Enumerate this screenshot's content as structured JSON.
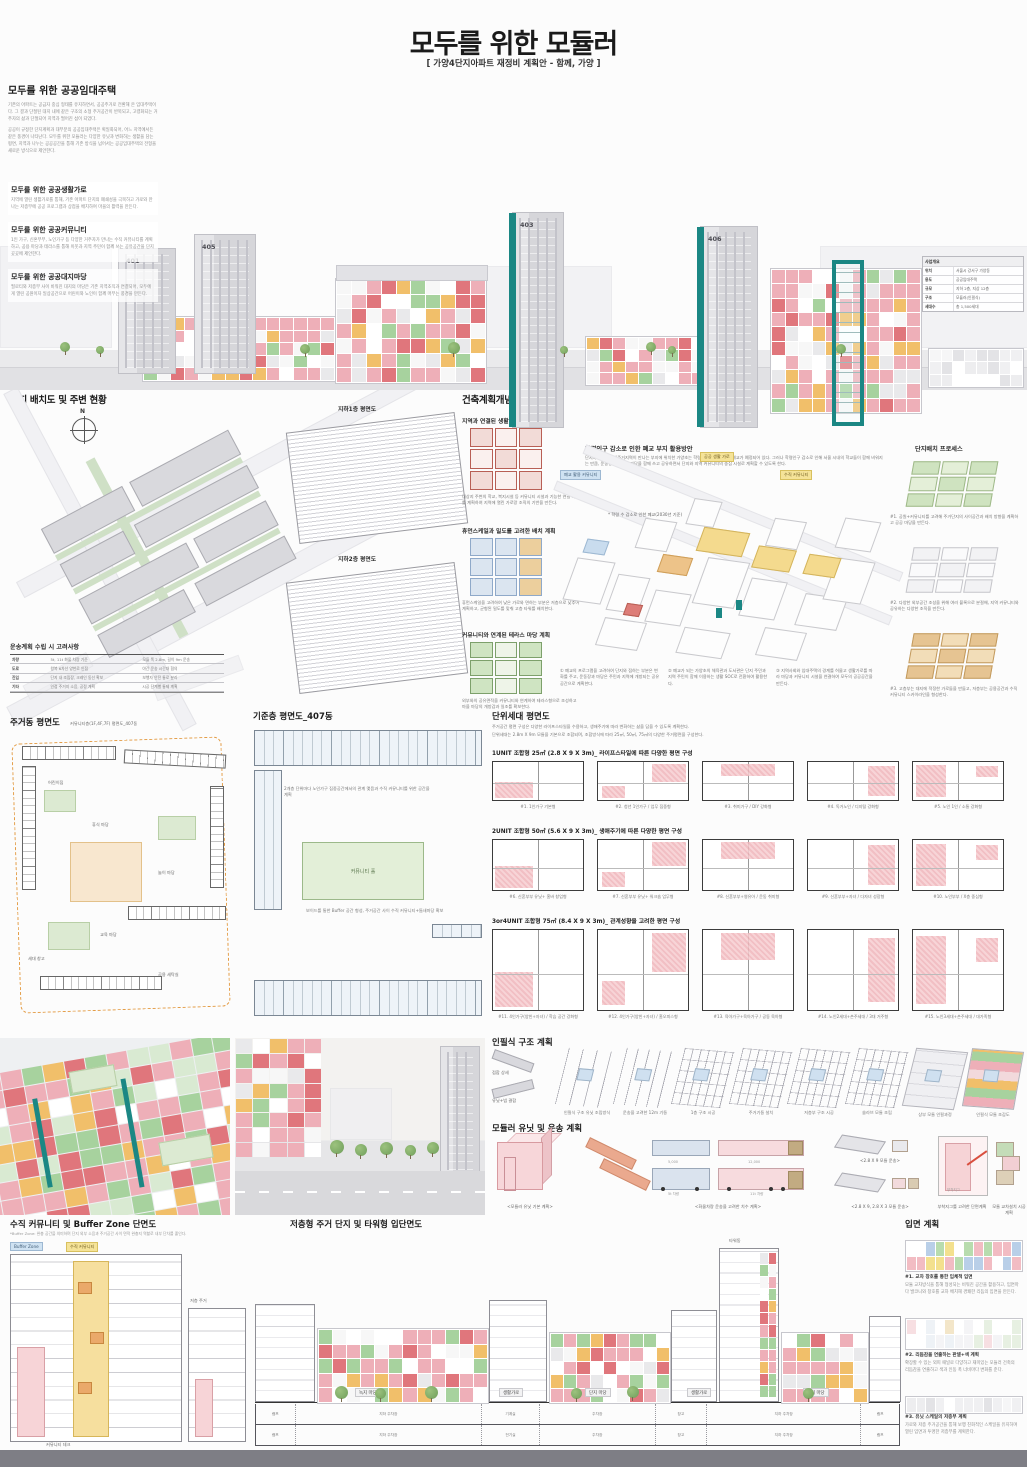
{
  "palette": {
    "teal": "#1b8784",
    "pink": "#eeafb8",
    "red": "#e0767c",
    "green": "#a7d29e",
    "yellow": "#f1bf6a",
    "gray_building": "#d8d8dc",
    "ink": "#222222",
    "modules": {
      "default": [
        "#eeafb8",
        "#eeafb8",
        "#e0767c",
        "#a7d29e",
        "#f1bf6a",
        "#f7f7f7",
        "#ffffff",
        "#e9e9eb",
        "#eeafb8"
      ],
      "aerial": [
        "#eeafb8",
        "#e0767c",
        "#a7d29e",
        "#a7d29e",
        "#f1bf6a",
        "#eeafb8",
        "#ffffff",
        "#d9ead2"
      ],
      "pastel": [
        "#f3e08e",
        "#b8dcae",
        "#f2bcc3",
        "#b9cfe8",
        "#ffffff",
        "#f3f3f4"
      ],
      "pastel2": [
        "#eef2f6",
        "#f3e6c9",
        "#e7f0e2",
        "#ffffff",
        "#f7dfe2",
        "#f4f4f6"
      ],
      "faint": [
        "#ededef",
        "#f6f6f7",
        "#e3e3e6",
        "#ffffff",
        "#f0f0f2"
      ]
    }
  },
  "header": {
    "title": "모두를 위한 모듈러",
    "subtitle": "[ 가양4단지아파트 재정비 계획안 - 함께, 가양 ]"
  },
  "intro": {
    "title": "모두를 위한 공공임대주택",
    "p1": "기존의 아파트는 공급자 중심 형태를 유지하면서, 공공주거로 전환해 온 임대주택이다. 그 결과 단절된 대지 내에 같은 구조의 소형 주거공간이 반복되고, 고령화되는 거주자의 삶과 단절되어 지역과 떨어진 섬이 되었다.",
    "p2": "공공이 규정한 단지계획과 대부분의 공공임대주택은 획일화되어, 어느 지역에서든 같은 풍경이 나타난다. 모두를 위한 모듈러는 다양한 유닛과 변화하는 생활을 담는 평면, 지역과 나누는 공공공간을 통해 기존 방식을 넘어서는 공공임대주택의 전형을 새로운 방식으로 제안한다.",
    "subsections": [
      {
        "title": "모두를 위한 공공생활가로",
        "body": "지역에 열린 생활가로를 통해, 기존 아파트 단지의 폐쇄성을 극복하고 가로와 만나는 저층부에 공공 프로그램과 상점을 배치하여 마을의 활력을 만든다."
      },
      {
        "title": "모두를 위한 공공커뮤니티",
        "body": "1인 가구, 신혼부부, 노인가구 등 다양한 거주자가 만나는 수직 커뮤니티를 계획하고, 공용 마당과 테라스를 통해 이웃과 지역 주민이 함께 쓰는 공유공간을 단지 곳곳에 제안한다."
      },
      {
        "title": "모두를 위한 공공대지마당",
        "body": "필로티와 저층부 사이 비워진 대지의 마당은 기존 지역조직과 연결되어, 모두에게 열린 공원이자 일상공간으로 어린이와 노인이 함께 머무는 풍경을 만든다."
      }
    ]
  },
  "hero": {
    "towers": {
      "t1": "401",
      "t2": "405",
      "t3": "403",
      "t4": "406"
    },
    "summary": {
      "title": "사업개요",
      "rows": [
        [
          "위치",
          "서울시 강서구 가양동"
        ],
        [
          "용도",
          "공공임대주택"
        ],
        [
          "규모",
          "지하 2층, 지상 12층"
        ],
        [
          "구조",
          "모듈러(인필식)"
        ],
        [
          "세대수",
          "총 1,500세대"
        ]
      ]
    }
  },
  "site": {
    "title": "단지 배치도 및 주변 현황",
    "compass": "N",
    "b1_label": "지하1층 평면도",
    "b2_label": "지하2층 평면도",
    "table_title": "운송계획 수립 시 고려사항",
    "table_rows": [
      [
        "차량",
        "5t, 11t 화물 차량 기준",
        "모듈 폭 2.8m, 길이 9m 운송"
      ],
      [
        "도로",
        "왕복 6차선 양천로 인접",
        "야간 운송 시간대 협의"
      ],
      [
        "진입",
        "단지 내 조립장, 크레인 동선 확보",
        "보행자 안전 통로 분리"
      ],
      [
        "기타",
        "인접 주거지 소음, 공정 계획",
        "시공 단계별 통제 계획"
      ]
    ]
  },
  "concept": {
    "title": "건축계획개념",
    "left": [
      {
        "title": "지역과 연결된 생활 가로 계획",
        "body": "대상지 주변의 학교, 복지시설 등 커뮤니티 시설과 기능한 연결 가로를 계획하여 지역에 열린 가로망 조직의 기반을 만든다."
      },
      {
        "title": "휴먼스케일과 밀도를 고려한 배치 계획",
        "body": "휴먼스케일을 고려하여 낮은 가로와 면하는 부분은 저층으로 낮추어 계획하고, 균형된 밀도를 맞춰 고층 타워를 배치한다."
      },
      {
        "title": "커뮤니티와 연계된 테라스 마당 계획",
        "body": "외부와의 공유면적을 커뮤니티와 연계하여 테라스형으로 조성하고 마을 마당의 개방감과 일조를 확보한다."
      }
    ],
    "main": {
      "title": "학령인구 감소로 인한 폐교 부지 활용방안",
      "body": "단지와 제1종 일반주거지역이 만나는 부지에 위치한 가양초는 학령인구 감소로 인해 폐교가 예정되어 있다. 그러나 학령인구 감소로 인해 서울 시내의 학교들이 함께 비워지는 만큼, 운동장과 단지의 마당을 함께 쓰고 공유하면서 단지와 지역 커뮤니티의 중심 시설로 계획할 수 있도록 한다.",
      "note": "* 학령 수 감소로 인한 폐교(2030년 기준)",
      "tags": [
        "폐교 활용 커뮤니티",
        "공공 생활 가로",
        "수직 커뮤니티"
      ],
      "captions": [
        "① 폐교의 프로그램을 고려하여 단지와 접하는 부분은 변화를 주고, 운동장과 마당은 주민과 지역에 개방되는 공유 공간으로 계획한다.",
        "② 폐교가 되는 가양초의 체육관과 도서관은 단지 주민과 지역 주민이 함께 이용하는 생활 SOC로 전환하여 활용한다.",
        "③ 지역사회와 임대주택의 경계를 허물고 생활가로를 따라 마당과 커뮤니티 시설을 연결하여 모두의 공공공간을 만든다."
      ]
    },
    "process": {
      "title": "단지배치 프로세스",
      "steps": [
        {
          "label": "#1. 공원+커뮤니티를 고려해 주거단지의 사이공간과 배치 방향을 계획하고 공공 마당을 만든다."
        },
        {
          "label": "#2. 다양한 외부공간 조성을 위해 여러 블록으로 분절해, 지역 커뮤니티와 공유하는 다양한 조직을 만든다."
        },
        {
          "label": "#3. 고층부는 대지에 적정한 가로들을 만들고, 저층부는 공용공간과 수직 커뮤니티 스카이라인을 형성한다."
        }
      ]
    }
  },
  "plans": {
    "residential_title": "주거동 평면도",
    "residential_sub": "커뮤니티층(1F,4F,7F) 평면도_407동",
    "residential_labels": [
      "휴식 마당",
      "교육 마당",
      "놀이 마당",
      "세대 창고",
      "어린이집",
      "공용 세탁실"
    ],
    "typical_title": "기준층 평면도_407동",
    "typical_note1": "2개층 단위마다 노인가구 집중공간에서의 관계 맺음과 수직 커뮤니티를 위한 공간을 계획",
    "typical_note2": "보이드를 통한 Buffer 공간 형성, 주거공간 사이 수직 커뮤니티+틈새마당 확보",
    "typical_hall": "커뮤니티 홀",
    "unit_title": "단위세대 평면도",
    "unit_intro1": "주거공간 평면 구성은 다양한 라이프스타일을 수용하고, 생애주기에 따라 변화하는 삶을 담을 수 있도록 계획한다.",
    "unit_intro2": "단위세대는 2.8m X 9m 모듈을 기본으로 조합되며, 조합방식에 따라 25㎡, 50㎡, 75㎡의 다양한 주거평면을 구성한다.",
    "groups": [
      {
        "heading": "1UNIT 조합형 25㎡ (2.8 X 9 X 3m)_ 라이프스타일에 따른 다양한 평면 구성",
        "units": [
          "#1. 1인가구 기본형",
          "#2. 청년 1인가구 / 업무 집중형",
          "#3. 취미가구 / DIY 강화형",
          "#4. 독거노인 / 디지털 강화형",
          "#5. 노인 1인 / 소통 강화형"
        ]
      },
      {
        "heading": "2UNIT 조합형 50㎡ (5.6 X 9 X 3m)_ 생애주기에 따른 다양한 평면 구성",
        "units": [
          "#6. 신혼부부 유닛+ 홈바 창업형",
          "#7. 신혼부부 유닛+ 워크숍 업무형",
          "#8. 신혼부부+영유아 / 운동 취미형",
          "#9. 신혼부부+자녀 / 다자녀 성장형",
          "#10. 노인부부 / X층 중심형"
        ]
      },
      {
        "heading": "3or4UNIT 조합형 75㎡ (8.4 X 9 X 3m)_ 관계성향을 고려한 평면 구성",
        "units": [
          "#11. 4인가구(양친+자녀) / 학습 공간 강화형",
          "#12. 4인가구(양친+자녀) / 홈오피스형",
          "#13. 육아가구+육아가구 / 공동 육아형",
          "#14. 노인2세대+손주세대 / 3대 거주형",
          "#15. 노인3세대+손주세대 / 대가족형"
        ]
      }
    ]
  },
  "infill": {
    "title": "인필식 구조 계획",
    "legend_top": "접합 상세",
    "legend_bottom": "유닛+빔 결합",
    "steps": [
      "인필식 구조 유닛 조립방식",
      "운송을 고려한 12m 기둥",
      "1층 구조 시공",
      "주거기둥 설치",
      "저층부 구조 시공",
      "슬라브 모듈 조립",
      "상부 모듈 인필과정",
      "인필식 모듈 조감도"
    ]
  },
  "transport": {
    "title": "모듈러 유닛 및 운송 계획",
    "unit_caption": "<모듈러 유닛 기본 계획>",
    "truck_caption": "<화물차량 운송을 고려한 치수 계획>",
    "module_caption1": "<2.8 X 9 모듈 운송>",
    "module_caption2": "<2.8 X 9, 2.8 X 3 모듈 운송>",
    "jig_caption": "부착지그를 고려한 단면계획",
    "stack_caption": "모듈 교차설치 시공계획",
    "truck1_label": "5t 차량",
    "truck2_label": "11t 차량",
    "dim1": "5,000",
    "dim2": "12,000",
    "dim3": "3,000",
    "jig_label": "부착지그"
  },
  "bottom": {
    "section_title": "수직 커뮤니티 및 Buffer Zone 단면도",
    "section_sub": "*Buffer Zone: 완충 공간을 의미하며 단지 외부 소음과 주거공간 사이 면적 완충지 역할로 내부 단차를 줄인다.",
    "section_labels": [
      "수직 커뮤니티",
      "Buffer Zone",
      "저층 주거",
      "커뮤니티 데크"
    ],
    "elevation_title": "저층형 주거 단지 및 타워형 입단면도",
    "tower_label": "타워동",
    "ground_labels": [
      "녹지 마당",
      "생활가로",
      "단지 마당",
      "생활가로",
      "복지 마당"
    ],
    "parking_rows": [
      [
        "램프",
        "지하 주차장",
        "기계실",
        "주차장",
        "창고",
        "지하 주차장",
        "램프"
      ],
      [
        "램프",
        "지하 주차장",
        "전기실",
        "주차장",
        "창고",
        "지하 주차장",
        "램프"
      ]
    ],
    "facade": {
      "title": "입면 계획",
      "items": [
        {
          "label": "#1. 교차 창호를 통한 입체적 입면",
          "body": "모듈 교차방식을 통해 형성되는 비워진 공간을 활용하고, 입면마다 발코니와 창호를 교차 배치해 경쾌한 리듬의 입면을 만든다."
        },
        {
          "label": "#2. 리듬감을 연출하는 판넬+색 계획",
          "body": "확장할 수 있는 외피 패널로 다양하고 재미있는 모듈러 건축의 리듬감을 연출하고 색과 인동 폭 너비마다 변화를 준다."
        },
        {
          "label": "#3. 유닛 스케일의 저층부 계획",
          "body": "가로와 저층 주거공간을 통해 보행 친화적인 스케일을 유지하며 열린 입면과 투명한 저층부를 계획한다."
        }
      ]
    }
  }
}
